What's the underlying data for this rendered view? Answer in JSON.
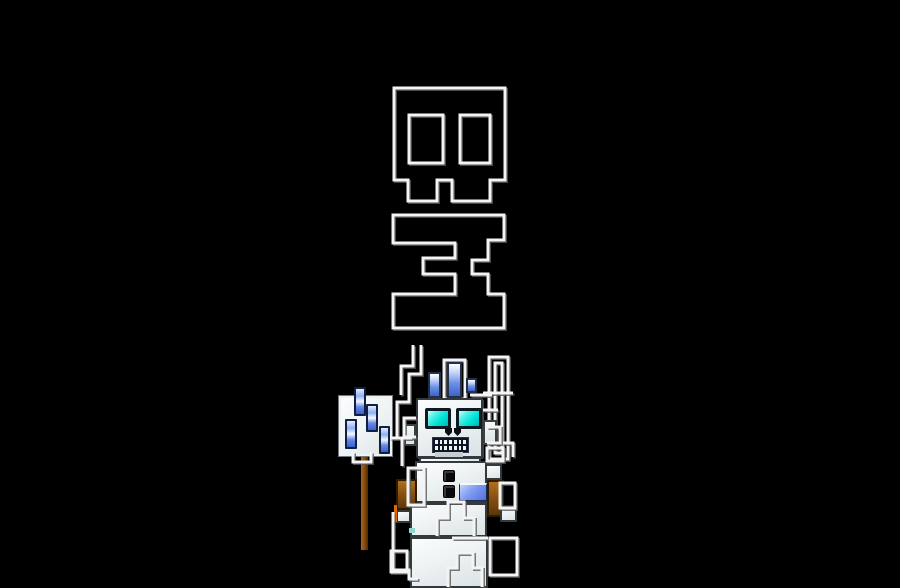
{
  "artwork": {
    "background": "#000000",
    "palette": {
      "background": "#000000",
      "outline_white": "#f4f4f4",
      "outline_shadow": "#5a5a5a",
      "robot_white": "#eef3f3",
      "robot_white_dark": "#dbe3e5",
      "eye_cyan": "#00e4da",
      "eye_frame": "#0b1b22",
      "antenna_blue": "#6d90e6",
      "antenna_blue_deep": "#3f63c8",
      "panel_blue": "#5272da",
      "arm_brown": "#8a5212",
      "arm_brown_dark": "#5d3608",
      "accent_orange": "#e06800",
      "pole_brown": "#83490d",
      "mouth_dark": "#0e1624",
      "button_black": "#090909",
      "sign_white": "#f2f6f7"
    },
    "robot": {
      "mouth": {
        "teeth_rows": 2,
        "teeth_cols": 7
      }
    },
    "svg_layers": {
      "behind": [
        {
          "name": "skull-glyph-outline",
          "d": "M394,88 H505 V180 H490 V201 H452 V180 H437 V201 H408 V180 H394 Z"
        },
        {
          "name": "skull-glyph-left-eye-hole",
          "d": "M409,115 h34 v48 h-34 Z"
        },
        {
          "name": "skull-glyph-right-eye-hole",
          "d": "M460,115 h30 v48 h-30 Z"
        },
        {
          "name": "letter-glyph-outline",
          "d": "M393,215 H504 V240 H488 V260 H472 V274 H488 V294 H504 V328 H393 V294 H455 V274 H423 V258 H455 V243 H393 Z"
        },
        {
          "name": "glyph3-bar-outer",
          "d": "M489,357 h19 v102 h-19 Z"
        },
        {
          "name": "glyph3-bar-inner",
          "d": "M495,363 h7 v90 h-7 Z"
        },
        {
          "name": "glyph3-stair-outer",
          "d": "M421,345 V374 H409 V402 H397 V438"
        },
        {
          "name": "glyph3-stair-inner",
          "d": "M413,345 V366 H401 V395"
        },
        {
          "name": "antenna-outline-box",
          "d": "M444,360 h21 v39 h-21 Z"
        }
      ],
      "front": [
        {
          "name": "fragment-line-left",
          "d": "M390,438 H412"
        },
        {
          "name": "fragment-bracket-left-of-head",
          "d": "M416,418 H404 V437 H416"
        },
        {
          "name": "fragment-vertical-left",
          "d": "M402,438 V466"
        },
        {
          "name": "fragment-line-right-of-head-1",
          "d": "M483,393 H513"
        },
        {
          "name": "fragment-line-right-of-head-2",
          "d": "M483,410 H498"
        },
        {
          "name": "fragment-bracket-right",
          "d": "M487,427 H500 V443 H487"
        },
        {
          "name": "fragment-bar-foot",
          "d": "M503,443 H513 V457"
        },
        {
          "name": "fragment-line-above-head",
          "d": "M470,395 H492"
        },
        {
          "name": "fragment-shoulder-left-box",
          "d": "M408,468 h16 v37 h-16 Z"
        },
        {
          "name": "fragment-shoulder-right-box",
          "d": "M500,483 h15 v25 h-15 Z"
        },
        {
          "name": "fragment-top-right-box",
          "d": "M487,448 h16 v13 h-16 Z"
        },
        {
          "name": "fragment-torso-zigzag",
          "d": "M437,536 V518 H448 V502 H464 V518 H474 V536"
        },
        {
          "name": "fragment-leg-zigzag",
          "d": "M448,587 V568 H457 V553 H473 V568 H482 V587"
        },
        {
          "name": "fragment-leg-top-line",
          "d": "M452,538 H488"
        },
        {
          "name": "fragment-bottom-right-box",
          "d": "M490,538 h27 v37 h-27 Z"
        },
        {
          "name": "fragment-bottom-left-bracket",
          "d": "M393,512 V570 H409 V579 H418"
        },
        {
          "name": "fragment-left-small-box",
          "d": "M391,551 h16 v21 h-16 Z"
        },
        {
          "name": "fragment-sign-pole-bracket",
          "d": "M353,452 V462 H371 V452"
        }
      ]
    }
  }
}
